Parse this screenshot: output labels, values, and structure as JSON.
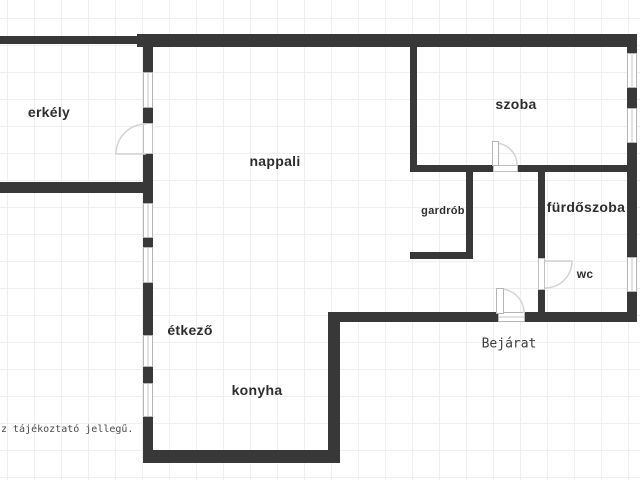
{
  "plan": {
    "type": "apartment-floor-plan",
    "rooms": {
      "erkely": "erkély",
      "nappali": "nappali",
      "szoba": "szoba",
      "gardrob": "gardrób",
      "furdoszoba": "fürdőszoba",
      "wc": "wc",
      "etkezo": "étkező",
      "konyha": "konyha"
    },
    "annotations": {
      "entrance": "Bejárat",
      "disclaimer": "z tájékoztató jellegű."
    },
    "colors": {
      "wall": "#383838",
      "window_border": "#b5b5b5",
      "door_arc": "#d4d4d4",
      "label_text": "#2d2d2d",
      "grid_line": "#f1efee",
      "background": "#ffffff"
    }
  }
}
